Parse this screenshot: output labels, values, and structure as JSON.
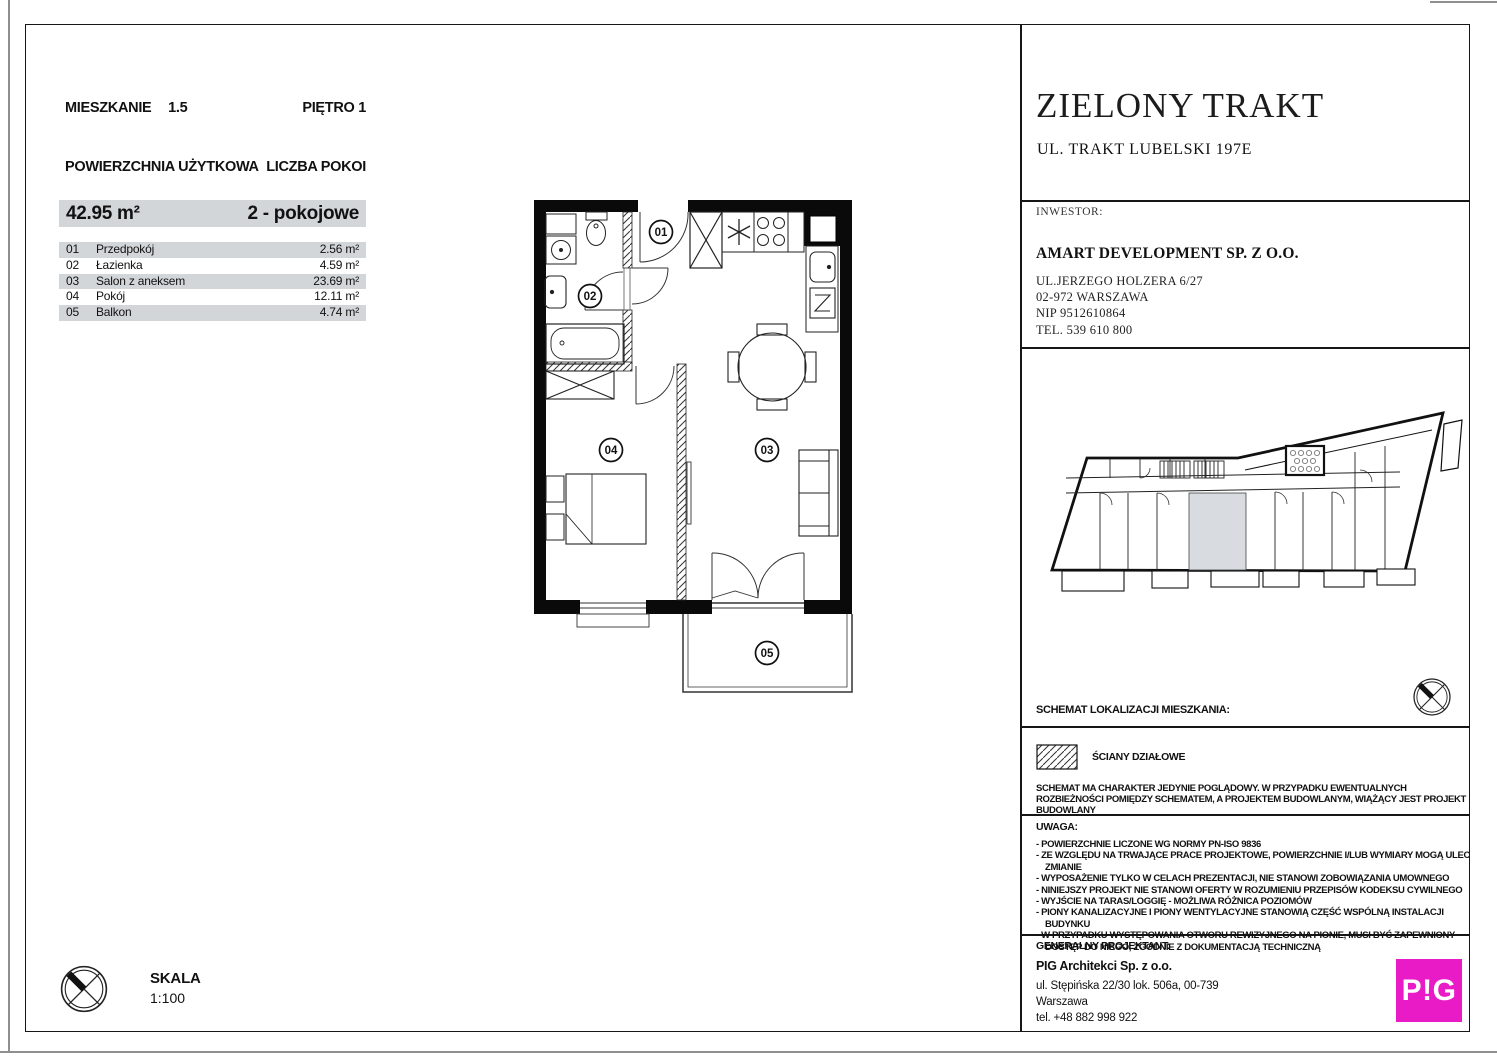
{
  "unit": {
    "label": "MIESZKANIE",
    "number": "1.5",
    "floor": "PIĘTRO 1",
    "area_label": "POWIERZCHNIA UŻYTKOWA",
    "rooms_label": "LICZBA POKOI",
    "area": "42.95 m²",
    "rooms_type": "2 - pokojowe",
    "rows": [
      {
        "no": "01",
        "name": "Przedpokój",
        "area": "2.56 m²"
      },
      {
        "no": "02",
        "name": "Łazienka",
        "area": "4.59 m²"
      },
      {
        "no": "03",
        "name": "Salon z aneksem",
        "area": "23.69 m²"
      },
      {
        "no": "04",
        "name": "Pokój",
        "area": "12.11 m²"
      },
      {
        "no": "05",
        "name": "Balkon",
        "area": "4.74 m²"
      }
    ]
  },
  "scale": {
    "label": "SKALA",
    "value": "1:100"
  },
  "plan": {
    "labels": [
      "01",
      "02",
      "03",
      "04",
      "05"
    ]
  },
  "right": {
    "title": "ZIELONY TRAKT",
    "address": "UL. TRAKT LUBELSKI 197E",
    "investor_label": "INWESTOR:",
    "investor_name": "AMART DEVELOPMENT SP. Z O.O.",
    "investor_lines": [
      "UL.JERZEGO HOLZERA 6/27",
      "02-972 WARSZAWA",
      "NIP 9512610864",
      "TEL. 539 610 800"
    ],
    "schematic_label": "SCHEMAT LOKALIZACJI MIESZKANIA:",
    "legend_label": "ŚCIANY DZIAŁOWE",
    "disclaimer": "SCHEMAT MA CHARAKTER JEDYNIE POGLĄDOWY. W PRZYPADKU EWENTUALNYCH ROZBIEŻNOŚCI POMIĘDZY SCHEMATEM, A PROJEKTEM BUDOWLANYM, WIĄŻĄCY JEST PROJEKT BUDOWLANY",
    "notes_label": "UWAGA:",
    "notes": [
      "POWIERZCHNIE LICZONE WG NORMY PN-ISO 9836",
      "ZE WZGLĘDU NA TRWAJĄCE PRACE PROJEKTOWE, POWIERZCHNIE I/LUB WYMIARY MOGĄ ULEC ZMIANIE",
      "WYPOSAŻENIE TYLKO W CELACH PREZENTACJI, NIE STANOWI ZOBOWIĄZANIA UMOWNEGO",
      "NINIEJSZY PROJEKT NIE STANOWI OFERTY W ROZUMIENIU PRZEPISÓW KODEKSU CYWILNEGO",
      "WYJŚCIE NA TARAS/LOGGIĘ - MOŻLIWA RÓŻNICA POZIOMÓW",
      "PIONY KANALIZACYJNE I PIONY WENTYLACYJNE  STANOWIĄ CZĘŚĆ WSPÓLNĄ INSTALACJI BUDYNKU",
      "W PRZYPADKU WYSTĘPOWANIA OTWORU REWIZYJNEGO NA PIONIE, MUSI BYĆ ZAPEWNIONY DOSTĘP DO NIEGO, ZGODNIE Z DOKUMENTACJĄ TECHNICZNĄ"
    ],
    "designer_label": "GENERALNY PROJEKTANT:",
    "designer_name": "PIG Architekci Sp. z o.o.",
    "designer_lines": [
      "ul. Stępińska 22/30 lok. 506a, 00-739",
      "Warszawa",
      "tel. +48 882 998 922"
    ],
    "logo": "P!G",
    "logo_color": "#E91BC7"
  }
}
